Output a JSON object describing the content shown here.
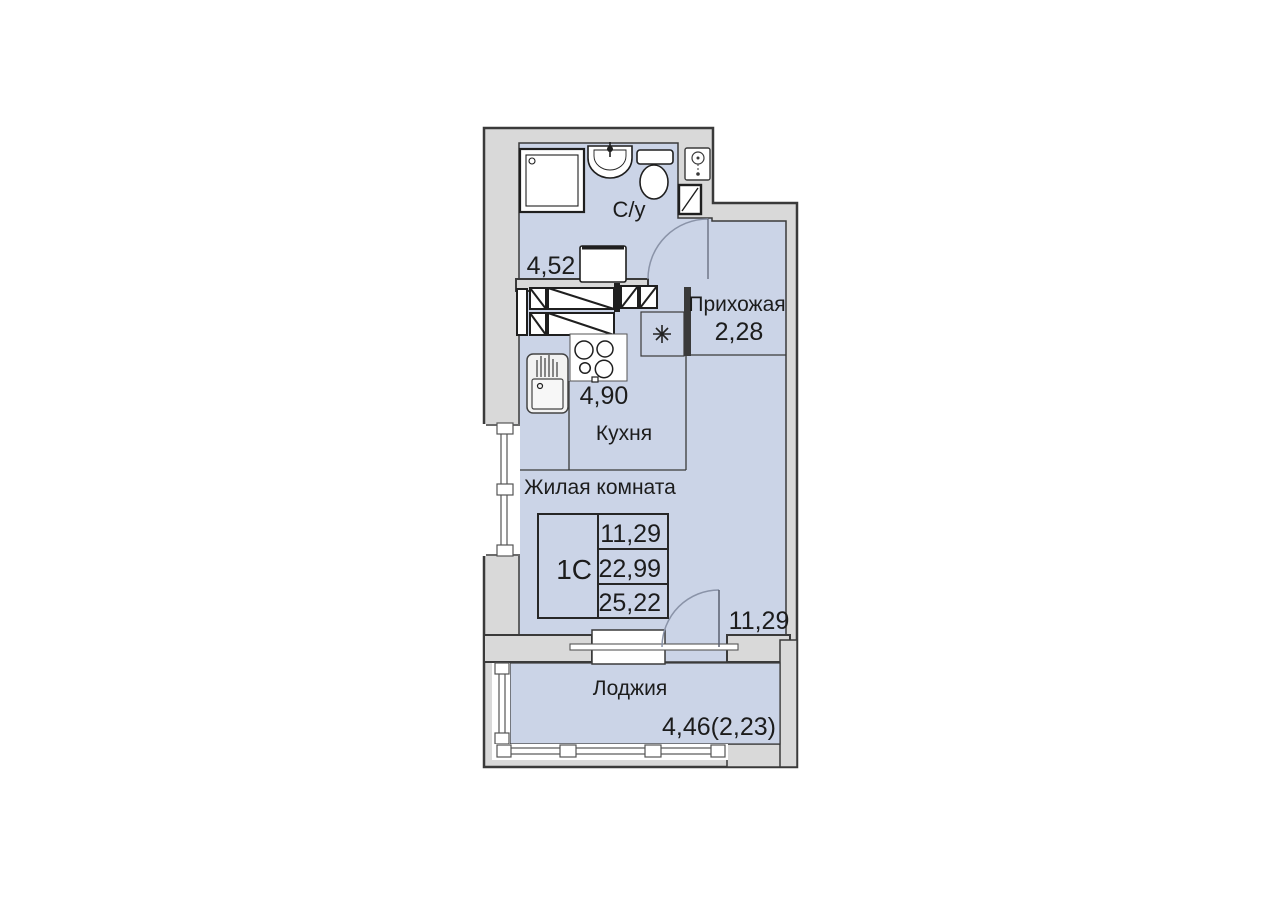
{
  "floor_plan": {
    "unit_type_stamp": {
      "type": "1С",
      "living_area": "11,29",
      "area_without_loggia": "22,99",
      "total_area": "25,22"
    },
    "rooms": [
      {
        "name": "С/у",
        "area": "4,52"
      },
      {
        "name": "Прихожая",
        "area": "2,28"
      },
      {
        "name": "Кухня",
        "area": "4,90"
      },
      {
        "name": "Жилая комната",
        "area": "11,29"
      },
      {
        "name": "Лоджия",
        "area": "4,46(2,23)"
      }
    ],
    "symbols": {
      "fridge_marker": "✳"
    },
    "colors": {
      "room_fill": "#cbd4e7",
      "wall_fill": "#d9d9d9",
      "outline": "#3a3a3a",
      "door_arc": "#8a93a8"
    }
  }
}
